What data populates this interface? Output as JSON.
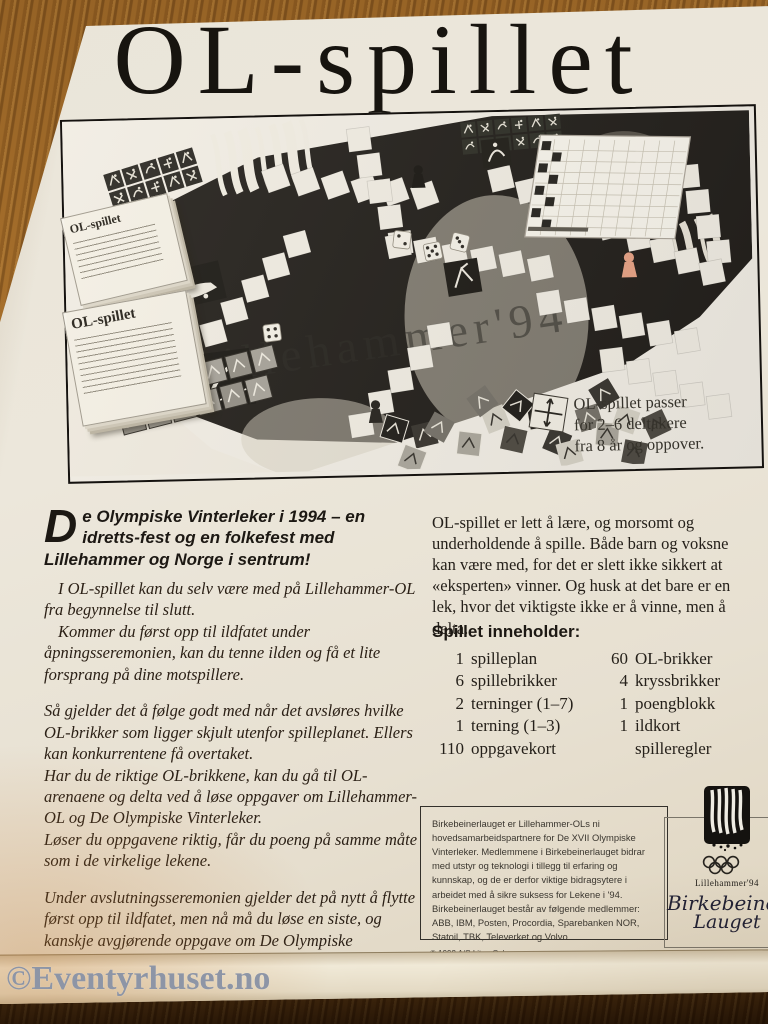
{
  "watermark": "©Eventyrhuset.no",
  "box": {
    "title": "OL-spillet",
    "photo": {
      "card_label_top": "OL-spillet",
      "card_label_bottom": "OL-spillet",
      "board_text": "illehammer'94",
      "caption_lines": [
        "OL-spillet passer",
        "for 2–6 deltakere",
        "fra 8 år og oppover."
      ]
    },
    "intro": {
      "dropcap": "D",
      "line": "e Olympiske Vinterleker i 1994 – en idretts-fest og en folkefest med Lillehammer og Norge i sentrum!"
    },
    "left_paragraphs": [
      {
        "text": "I OL-spillet kan du selv være med på Lillehammer-OL fra begynnelse til slutt."
      },
      {
        "text": "Kommer du først opp til ildfatet under åpningsseremonien, kan du tenne ilden og få et lite forsprang på dine motspillere."
      },
      {
        "text": "Så gjelder det å følge godt med når det avsløres hvilke OL-brikker som ligger skjult utenfor spilleplanet. Ellers kan konkurrentene få overtaket."
      },
      {
        "text": "Har du de riktige OL-brikkene, kan du gå til OL-arenaene og delta ved å løse oppgaver om Lillehammer-OL og De Olympiske Vinterleker."
      },
      {
        "text": "Løser du oppgavene riktig, får du poeng på samme måte som i de virkelige lekene."
      },
      {
        "text": "Under avslutningsseremonien gjelder det på nytt å flytte først opp til ildfatet, men nå må du løse en siste, og kanskje avgjørende oppgave om De Olympiske Vinterleker for å slukke ilden."
      }
    ],
    "right_paragraph": "OL-spillet er lett å lære, og morsomt og underholdende å spille. Både barn og voksne kan være med, for det er slett ikke sikkert at «eksperten» vinner. Og husk at det bare er en lek, hvor det viktigste ikke er å vinne, men å delta.",
    "contents": {
      "heading": "Spillet inneholder:",
      "rows": [
        {
          "l_num": "1",
          "l_item": "spilleplan",
          "r_num": "60",
          "r_item": "OL-brikker"
        },
        {
          "l_num": "6",
          "l_item": "spillebrikker",
          "r_num": "4",
          "r_item": "kryssbrikker"
        },
        {
          "l_num": "2",
          "l_item": "terninger (1–7)",
          "r_num": "1",
          "r_item": "poengblokk"
        },
        {
          "l_num": "1",
          "l_item": "terning (1–3)",
          "r_num": "1",
          "r_item": "ildkort"
        },
        {
          "l_num": "110",
          "l_item": "oppgavekort",
          "r_num": "",
          "r_item": "spilleregler"
        }
      ]
    },
    "sponsor_text": "Birkebeinerlauget er Lillehammer-OLs ni hovedsamarbeidspartnere for De XVII Olympiske Vinterleker. Medlemmene i Birkebeinerlauget bidrar med utstyr og teknologi i tillegg til erfaring og kunnskap, og de er derfor viktige bidragsytere i arbeidet med å sikre suksess for Lekene i '94. Birkebeinerlauget består av følgende medlemmer: ABB, IBM, Posten, Procordia, Sparebanken NOR, Statoil, TBK, Televerket og Volvo.",
    "logo": {
      "event": "Lillehammer'94",
      "org_line1": "Birkebeiner",
      "org_line2": "Lauget"
    },
    "copyright": {
      "line1": "© 1992 A/S Litor, Oslo",
      "line2": "© LOOC/OL'94 OL-merker"
    }
  },
  "colors": {
    "box_cream": "#ebe5d8",
    "ink": "#17140f",
    "watermark_gray": "#8d95a6",
    "wood_brown": "#8f5d22",
    "salmon_pawn": "#e8a083"
  }
}
